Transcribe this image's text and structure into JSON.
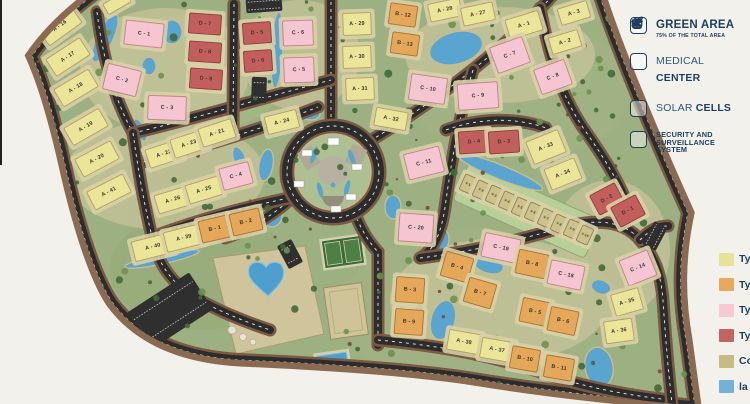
{
  "page": {
    "background_color": "#f3f1ec",
    "kind": "residential compound master plan"
  },
  "legend": {
    "text_color": "#1c3e5d",
    "items": [
      {
        "icon": "tree-icon",
        "light": "",
        "bold": "GREEN AREA",
        "sub": "75% OF THE TOTAL AREA",
        "bold2": ""
      },
      {
        "icon": "medical-bag-icon",
        "light": "MEDICAL ",
        "bold": "CENTER",
        "sub": "",
        "bold2": ""
      },
      {
        "icon": "solar-panel-icon",
        "light": "SOLAR ",
        "bold": "CELLS",
        "sub": "",
        "bold2": ""
      },
      {
        "icon": "cctv-camera-icon",
        "light": "",
        "bold": "SECURITY AND",
        "sub": "",
        "bold2": "SURVEILLANCE SYSTEM"
      }
    ]
  },
  "unit_type_legend": {
    "entries": [
      {
        "label": "Ty",
        "color": "#e7e297"
      },
      {
        "label": "Ty",
        "color": "#e7a95b"
      },
      {
        "label": "Ty",
        "color": "#f6c9d4"
      },
      {
        "label": "Ty",
        "color": "#c26462"
      },
      {
        "label": "Co",
        "color": "#c6bb82"
      },
      {
        "label": "la",
        "color": "#74b1d8"
      }
    ]
  },
  "map": {
    "label_color": "#3a352c",
    "type_colors": {
      "A": {
        "fill": "#ebe59a",
        "stroke": "#b0a15c"
      },
      "B": {
        "fill": "#e5a75a",
        "stroke": "#a8742f"
      },
      "C": {
        "fill": "#f5c6d1",
        "stroke": "#c2808f"
      },
      "D": {
        "fill": "#c25f5d",
        "stroke": "#8e3d3c"
      },
      "V": {
        "fill": "#cdc28a",
        "stroke": "#8f8257"
      }
    },
    "blocks": [
      {
        "label": "A - 16",
        "type": "A",
        "x": 60,
        "y": 26,
        "w": 40,
        "h": 20,
        "r": -36
      },
      {
        "label": "A - 17",
        "type": "A",
        "x": 68,
        "y": 57,
        "w": 40,
        "h": 20,
        "r": -33
      },
      {
        "label": "A - 18",
        "type": "A",
        "x": 76,
        "y": 88,
        "w": 40,
        "h": 20,
        "r": -31
      },
      {
        "label": "A - 19",
        "type": "A",
        "x": 86,
        "y": 127,
        "w": 40,
        "h": 20,
        "r": -30
      },
      {
        "label": "A - 20",
        "type": "A",
        "x": 97,
        "y": 159,
        "w": 40,
        "h": 20,
        "r": -28
      },
      {
        "label": "A - 41",
        "type": "A",
        "x": 109,
        "y": 192,
        "w": 40,
        "h": 20,
        "r": -27
      },
      {
        "label": "",
        "type": "A",
        "x": 117,
        "y": 3,
        "w": 26,
        "h": 12,
        "r": -30
      },
      {
        "label": "A - 22",
        "type": "A",
        "x": 164,
        "y": 154,
        "w": 34,
        "h": 19,
        "r": -18
      },
      {
        "label": "A - 23",
        "type": "A",
        "x": 189,
        "y": 144,
        "w": 34,
        "h": 19,
        "r": -18
      },
      {
        "label": "A - 21",
        "type": "A",
        "x": 217,
        "y": 133,
        "w": 34,
        "h": 19,
        "r": -18
      },
      {
        "label": "A - 26",
        "type": "A",
        "x": 173,
        "y": 200,
        "w": 34,
        "h": 19,
        "r": -17
      },
      {
        "label": "A - 25",
        "type": "A",
        "x": 204,
        "y": 190,
        "w": 34,
        "h": 19,
        "r": -17
      },
      {
        "label": "C - 4",
        "type": "C",
        "x": 236,
        "y": 176,
        "w": 30,
        "h": 22,
        "r": -15
      },
      {
        "label": "A - 40",
        "type": "A",
        "x": 153,
        "y": 247,
        "w": 40,
        "h": 20,
        "r": -14
      },
      {
        "label": "A - 39",
        "type": "A",
        "x": 184,
        "y": 238,
        "w": 38,
        "h": 20,
        "r": -14
      },
      {
        "label": "B - 1",
        "type": "B",
        "x": 215,
        "y": 229,
        "w": 30,
        "h": 22,
        "r": -13
      },
      {
        "label": "B - 2",
        "type": "B",
        "x": 246,
        "y": 222,
        "w": 30,
        "h": 22,
        "r": -13
      },
      {
        "label": "C - 1",
        "type": "C",
        "x": 144,
        "y": 34,
        "w": 38,
        "h": 24,
        "r": 6
      },
      {
        "label": "C - 2",
        "type": "C",
        "x": 122,
        "y": 80,
        "w": 34,
        "h": 26,
        "r": 14
      },
      {
        "label": "C - 3",
        "type": "C",
        "x": 167,
        "y": 108,
        "w": 38,
        "h": 24,
        "r": 2
      },
      {
        "label": "D - 7",
        "type": "D",
        "x": 205,
        "y": 24,
        "w": 32,
        "h": 20,
        "r": 4
      },
      {
        "label": "D - 8",
        "type": "D",
        "x": 205,
        "y": 52,
        "w": 32,
        "h": 20,
        "r": 4
      },
      {
        "label": "D - 9",
        "type": "D",
        "x": 206,
        "y": 79,
        "w": 32,
        "h": 20,
        "r": 4
      },
      {
        "label": "D - 5",
        "type": "D",
        "x": 257,
        "y": 33,
        "w": 28,
        "h": 21,
        "r": -4
      },
      {
        "label": "D - 6",
        "type": "D",
        "x": 258,
        "y": 61,
        "w": 28,
        "h": 21,
        "r": -4
      },
      {
        "label": "C - 6",
        "type": "C",
        "x": 298,
        "y": 33,
        "w": 30,
        "h": 25,
        "r": -2
      },
      {
        "label": "C - 5",
        "type": "C",
        "x": 299,
        "y": 70,
        "w": 30,
        "h": 25,
        "r": -2
      },
      {
        "label": "A - 29",
        "type": "A",
        "x": 357,
        "y": 24,
        "w": 28,
        "h": 22,
        "r": -2
      },
      {
        "label": "A - 30",
        "type": "A",
        "x": 357,
        "y": 57,
        "w": 28,
        "h": 22,
        "r": -2
      },
      {
        "label": "A - 31",
        "type": "A",
        "x": 360,
        "y": 89,
        "w": 28,
        "h": 22,
        "r": -2
      },
      {
        "label": "B - 12",
        "type": "B",
        "x": 403,
        "y": 15,
        "w": 27,
        "h": 21,
        "r": 8
      },
      {
        "label": "B - 13",
        "type": "B",
        "x": 405,
        "y": 44,
        "w": 27,
        "h": 21,
        "r": 8
      },
      {
        "label": "A - 28",
        "type": "A",
        "x": 445,
        "y": 10,
        "w": 32,
        "h": 18,
        "r": -12
      },
      {
        "label": "A - 27",
        "type": "A",
        "x": 478,
        "y": 14,
        "w": 32,
        "h": 18,
        "r": -12
      },
      {
        "label": "A - 1",
        "type": "A",
        "x": 524,
        "y": 25,
        "w": 34,
        "h": 20,
        "r": -17
      },
      {
        "label": "A - 3",
        "type": "A",
        "x": 574,
        "y": 13,
        "w": 30,
        "h": 17,
        "r": -17
      },
      {
        "label": "A - 2",
        "type": "A",
        "x": 565,
        "y": 42,
        "w": 30,
        "h": 17,
        "r": -17
      },
      {
        "label": "C - 7",
        "type": "C",
        "x": 510,
        "y": 55,
        "w": 34,
        "h": 27,
        "r": -20
      },
      {
        "label": "C - 8",
        "type": "C",
        "x": 553,
        "y": 77,
        "w": 32,
        "h": 26,
        "r": -20
      },
      {
        "label": "C - 10",
        "type": "C",
        "x": 428,
        "y": 89,
        "w": 36,
        "h": 26,
        "r": 8
      },
      {
        "label": "C - 9",
        "type": "C",
        "x": 478,
        "y": 96,
        "w": 40,
        "h": 26,
        "r": -4
      },
      {
        "label": "A - 24",
        "type": "A",
        "x": 282,
        "y": 122,
        "w": 32,
        "h": 18,
        "r": -14
      },
      {
        "label": "A - 32",
        "type": "A",
        "x": 391,
        "y": 119,
        "w": 32,
        "h": 18,
        "r": 10
      },
      {
        "label": "C - 11",
        "type": "C",
        "x": 424,
        "y": 163,
        "w": 36,
        "h": 26,
        "r": -14
      },
      {
        "label": "D - 4",
        "type": "D",
        "x": 474,
        "y": 142,
        "w": 30,
        "h": 22,
        "r": -4
      },
      {
        "label": "D - 3",
        "type": "D",
        "x": 504,
        "y": 142,
        "w": 30,
        "h": 22,
        "r": -4
      },
      {
        "label": "A - 33",
        "type": "A",
        "x": 546,
        "y": 147,
        "w": 34,
        "h": 24,
        "r": -22
      },
      {
        "label": "A - 34",
        "type": "A",
        "x": 563,
        "y": 174,
        "w": 32,
        "h": 22,
        "r": -22
      },
      {
        "label": "D - 2",
        "type": "D",
        "x": 607,
        "y": 199,
        "w": 28,
        "h": 22,
        "r": -28
      },
      {
        "label": "D - 1",
        "type": "D",
        "x": 628,
        "y": 211,
        "w": 28,
        "h": 22,
        "r": -28
      },
      {
        "label": "C - 20",
        "type": "C",
        "x": 416,
        "y": 228,
        "w": 34,
        "h": 28,
        "r": 4
      },
      {
        "label": "V-1",
        "type": "V",
        "x": 468,
        "y": 184,
        "w": 12,
        "h": 17,
        "r": 24
      },
      {
        "label": "V-2",
        "type": "V",
        "x": 481,
        "y": 190,
        "w": 12,
        "h": 17,
        "r": 24
      },
      {
        "label": "V-3",
        "type": "V",
        "x": 494,
        "y": 195,
        "w": 12,
        "h": 17,
        "r": 24
      },
      {
        "label": "V-4",
        "type": "V",
        "x": 507,
        "y": 201,
        "w": 12,
        "h": 17,
        "r": 24
      },
      {
        "label": "V-5",
        "type": "V",
        "x": 520,
        "y": 207,
        "w": 12,
        "h": 17,
        "r": 24
      },
      {
        "label": "V-6",
        "type": "V",
        "x": 533,
        "y": 212,
        "w": 12,
        "h": 17,
        "r": 24
      },
      {
        "label": "V-7",
        "type": "V",
        "x": 546,
        "y": 218,
        "w": 12,
        "h": 17,
        "r": 24
      },
      {
        "label": "V-8",
        "type": "V",
        "x": 559,
        "y": 224,
        "w": 12,
        "h": 17,
        "r": 24
      },
      {
        "label": "V-9",
        "type": "V",
        "x": 572,
        "y": 229,
        "w": 12,
        "h": 17,
        "r": 24
      },
      {
        "label": "V-10",
        "type": "V",
        "x": 585,
        "y": 235,
        "w": 12,
        "h": 17,
        "r": 24
      },
      {
        "label": "C - 19",
        "type": "C",
        "x": 501,
        "y": 248,
        "w": 36,
        "h": 24,
        "r": 12
      },
      {
        "label": "B - 8",
        "type": "B",
        "x": 532,
        "y": 264,
        "w": 30,
        "h": 24,
        "r": 12
      },
      {
        "label": "C - 18",
        "type": "C",
        "x": 566,
        "y": 275,
        "w": 34,
        "h": 24,
        "r": 12
      },
      {
        "label": "B - 4",
        "type": "B",
        "x": 457,
        "y": 267,
        "w": 28,
        "h": 25,
        "r": 16
      },
      {
        "label": "B - 7",
        "type": "B",
        "x": 480,
        "y": 293,
        "w": 28,
        "h": 25,
        "r": 16
      },
      {
        "label": "B - 3",
        "type": "B",
        "x": 410,
        "y": 290,
        "w": 28,
        "h": 25,
        "r": 4
      },
      {
        "label": "B - 9",
        "type": "B",
        "x": 409,
        "y": 322,
        "w": 28,
        "h": 25,
        "r": 4
      },
      {
        "label": "B - 5",
        "type": "B",
        "x": 535,
        "y": 312,
        "w": 28,
        "h": 24,
        "r": 12
      },
      {
        "label": "B - 6",
        "type": "B",
        "x": 563,
        "y": 321,
        "w": 28,
        "h": 24,
        "r": 12
      },
      {
        "label": "A - 38",
        "type": "A",
        "x": 464,
        "y": 342,
        "w": 32,
        "h": 20,
        "r": 10
      },
      {
        "label": "A - 37",
        "type": "A",
        "x": 497,
        "y": 350,
        "w": 32,
        "h": 20,
        "r": 10
      },
      {
        "label": "B - 10",
        "type": "B",
        "x": 525,
        "y": 359,
        "w": 28,
        "h": 22,
        "r": 10
      },
      {
        "label": "B - 11",
        "type": "B",
        "x": 559,
        "y": 368,
        "w": 28,
        "h": 22,
        "r": 10
      },
      {
        "label": "C - 14",
        "type": "C",
        "x": 638,
        "y": 268,
        "w": 30,
        "h": 27,
        "r": -22
      },
      {
        "label": "A - 35",
        "type": "A",
        "x": 627,
        "y": 302,
        "w": 28,
        "h": 22,
        "r": -16
      },
      {
        "label": "A - 36",
        "type": "A",
        "x": 619,
        "y": 331,
        "w": 28,
        "h": 22,
        "r": -8
      }
    ]
  }
}
